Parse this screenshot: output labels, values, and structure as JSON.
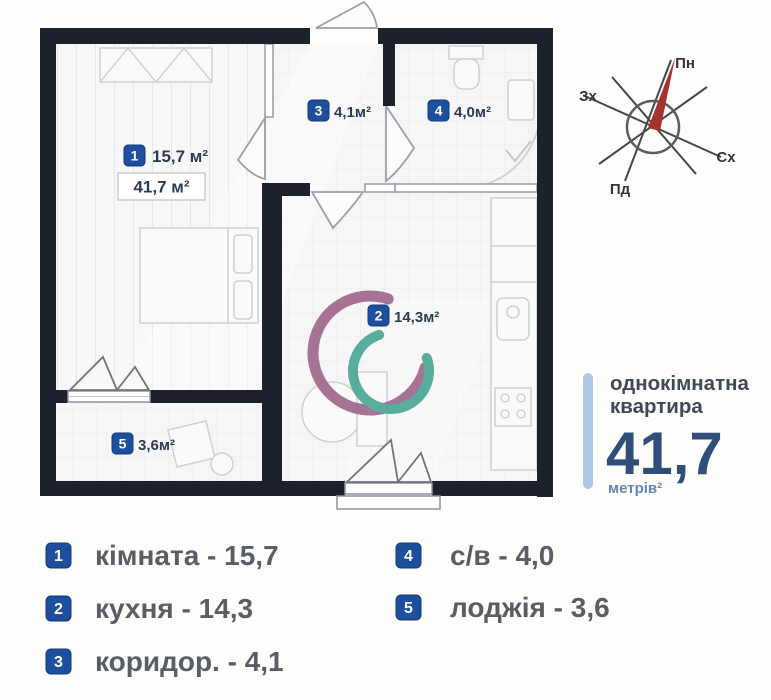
{
  "plan": {
    "room_labels": [
      {
        "num": "1",
        "area": "15,7 м²"
      },
      {
        "num": "2",
        "area": "14,3м²"
      },
      {
        "num": "3",
        "area": "4,1м²"
      },
      {
        "num": "4",
        "area": "4,0м²"
      },
      {
        "num": "5",
        "area": "3,6м²"
      }
    ],
    "total_area_box": "41,7 м²"
  },
  "compass": {
    "north": "Пн",
    "east": "Сх",
    "south": "Пд",
    "west": "Зх"
  },
  "summary": {
    "title_line1": "однокімнатна",
    "title_line2": "квартира",
    "area_value": "41,7",
    "area_unit": "метрів²"
  },
  "legend": {
    "items": [
      {
        "num": "1",
        "label": "кімната - 15,7"
      },
      {
        "num": "2",
        "label": "кухня - 14,3"
      },
      {
        "num": "3",
        "label": "коридор. - 4,1"
      },
      {
        "num": "4",
        "label": "с/в - 4,0"
      },
      {
        "num": "5",
        "label": "лоджія - 3,6"
      }
    ]
  },
  "colors": {
    "wall": "#1d212b",
    "badge_blue": "#1e4f9f",
    "accent_bar": "#abc8e5",
    "big_area_text": "#2f4e79",
    "legend_text": "#595e66",
    "compass_needle": "#a5322d",
    "watermark_outer": "#9c6188",
    "watermark_inner": "#43a391"
  }
}
